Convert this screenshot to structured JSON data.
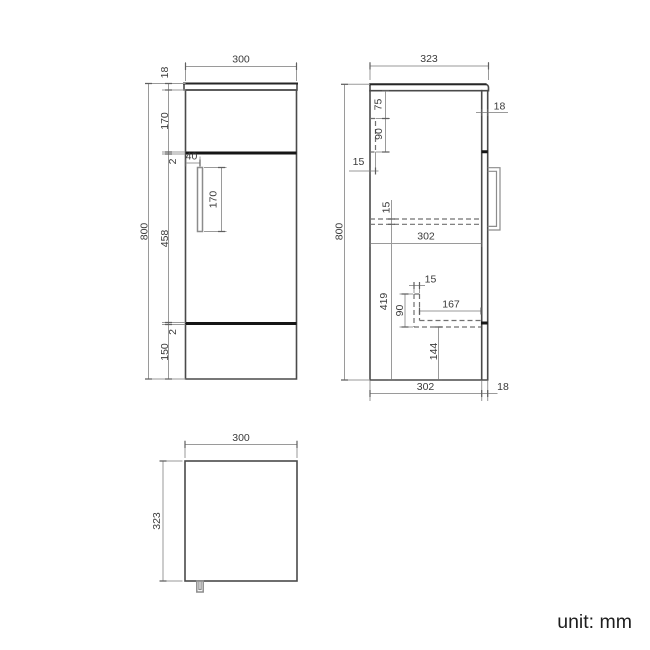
{
  "unit_label": "unit: mm",
  "front_view": {
    "width_top": "300",
    "counter_thickness": "18",
    "upper_panel_height": "170",
    "gap_upper": "2",
    "door_height": "458",
    "gap_lower": "2",
    "plinth_height": "150",
    "total_height": "800",
    "handle_offset": "40",
    "handle_length": "170"
  },
  "side_view": {
    "depth_top": "323",
    "total_height": "800",
    "door_thickness_top": "18",
    "bracket_offset": "75",
    "bracket_height": "90",
    "bracket_depth": "15",
    "shelf_thickness": "15",
    "interior_depth": "302",
    "lower_section_height": "419",
    "pipe_width": "15",
    "pipe_height": "90",
    "pipe_length": "167",
    "pipe_bottom_clearance": "144",
    "depth_bottom": "302",
    "door_thickness_bottom": "18"
  },
  "top_view": {
    "width": "300",
    "depth": "323"
  },
  "colors": {
    "outline": "#4a4a4a",
    "outline_dark": "#262626",
    "dimension_line": "#9a9a9a",
    "text": "#3a3a3a",
    "background": "#ffffff"
  }
}
